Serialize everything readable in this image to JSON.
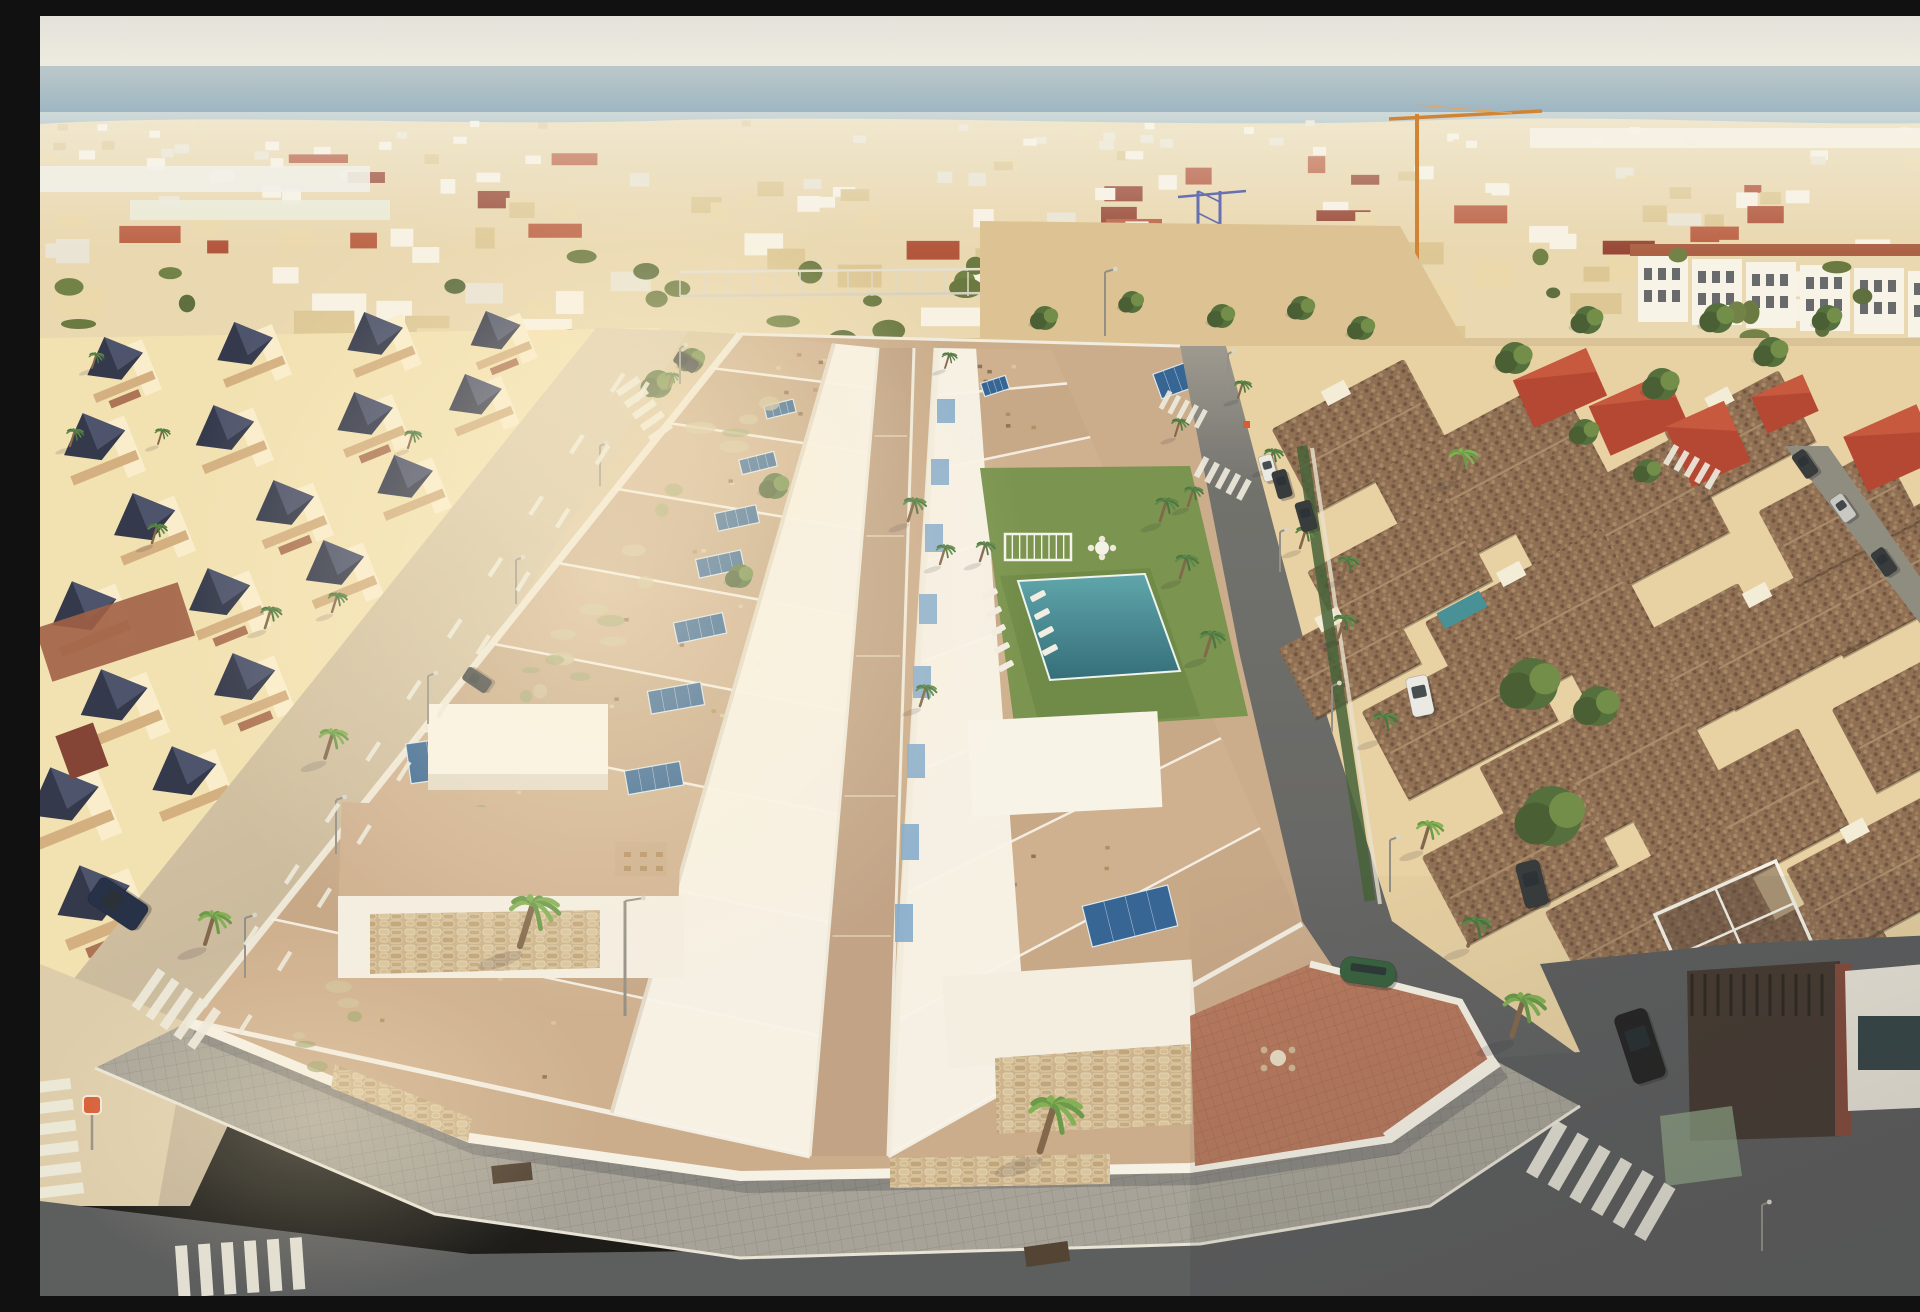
{
  "meta": {
    "label": "aerial-render-coastal-residential-development",
    "description": "computer-generated aerial view of a new white villa development with solar panels and communal pool beside older terracotta-roof urbanizations near the sea",
    "width": 1920,
    "height": 1280
  },
  "palette": {
    "sky_top": "#e3e2dd",
    "sky_horizon": "#efece3",
    "sea_far": "#b9c6cb",
    "sea_mid": "#6f9dbd",
    "sea_near": "#3f7ea9",
    "far_town_base": "#e8d7b0",
    "far_bld_white": "#f7f3e7",
    "far_bld_cream": "#ead8ab",
    "far_bld_sand": "#dcc694",
    "far_roof_red": "#ae4e36",
    "far_tree": "#64743c",
    "sand": "#d9c096",
    "dirt": "#dcc192",
    "left_wall": "#f2e1b2",
    "left_wall_lit": "#fbf0d2",
    "left_roof_dark": "#2a3047",
    "left_roof_light": "#4a5170",
    "left_parapet": "#d2ad7e",
    "left_roof_red": "#9c5a40",
    "ave_road": "#c8b698",
    "ave_road_lit": "#ddccab",
    "ave_walk": "#d8c4a0",
    "dev_white": "#f8f4ea",
    "dev_white_shade": "#e2dacb",
    "dev_terrace": "#c9aa8a",
    "dev_walkway": "#bfa084",
    "dev_stone": "#cbb28b",
    "panel_blue": "#2d5f93",
    "panel_frame": "#dce8f0",
    "glass_blue": "#7fa9cd",
    "straw": "#d8c094",
    "lawn": "#74904a",
    "lawn_dark": "#5e7a3a",
    "pool_deep": "#2b6877",
    "pool_light": "#57a3ab",
    "street_lit": "#98948a",
    "street_shade": "#5d5f60",
    "asphalt": "#55575a",
    "paver": "#a3a097",
    "paver_line": "#8d8a81",
    "curb": "#e8e4d8",
    "stripe": "#eceade",
    "right_wall": "#e7d0a2",
    "right_roof": "#8a6a50",
    "right_roof_dot": "#6b4e3a",
    "right_roof_dot2": "#a38363",
    "right_roof_red": "#b2402d",
    "terra": "#b3745a",
    "terra_line": "#9b6049",
    "palm_trunk": "#7d6247",
    "palm_dark": "#44703a",
    "palm_bright": "#649644",
    "tree_dark": "#4c6a36",
    "tree_light": "#6c8a44",
    "crane_orange": "#cf7f2e",
    "crane_blue": "#5f6ab0",
    "car_navy": "#1c2742",
    "car_white": "#e9e9e6",
    "car_black": "#1a1b1d",
    "car_dark": "#2f3336",
    "car_green": "#2f5c3a",
    "car_silver": "#c7c7c4",
    "hedge": "#3f5c33",
    "shadow": "rgba(45,42,60,0.28)",
    "glare": "rgba(255,242,210,0.32)",
    "sign_red": "#d4552e",
    "umbrella_yellow": "#e0b93c"
  },
  "scene": {
    "far_town": {
      "seed": 11,
      "building_count": 170,
      "red_roof_count": 22,
      "tree_count": 34,
      "band_top": 104,
      "band_bottom": 332
    },
    "cranes": {
      "orange": {
        "mast_x": 1377,
        "mast_top": 98,
        "mast_bottom": 322,
        "jib_x2": 1502,
        "jib_y": 95
      },
      "blue": {
        "x": 1158,
        "top": 175,
        "bottom": 490,
        "width": 22
      }
    },
    "development": {
      "left_row_units": 9,
      "right_row_units": 8,
      "solar_panels": [
        [
          740,
          393,
          30,
          13,
          -14
        ],
        [
          718,
          447,
          36,
          15,
          -14
        ],
        [
          697,
          502,
          42,
          18,
          -12
        ],
        [
          680,
          548,
          46,
          19,
          -12
        ],
        [
          660,
          612,
          50,
          21,
          -12
        ],
        [
          636,
          682,
          54,
          23,
          -10
        ],
        [
          614,
          762,
          56,
          24,
          -10
        ],
        [
          596,
          845,
          60,
          26,
          -8
        ],
        [
          410,
          742,
          84,
          40,
          -8
        ],
        [
          955,
          370,
          26,
          14,
          -18
        ],
        [
          1138,
          363,
          44,
          26,
          -20
        ],
        [
          1027,
          681,
          62,
          30,
          -16
        ],
        [
          1090,
          900,
          88,
          42,
          -14
        ]
      ],
      "glass_panels": [
        [
          906,
          395
        ],
        [
          900,
          455
        ],
        [
          894,
          520
        ],
        [
          888,
          590
        ],
        [
          882,
          662
        ],
        [
          876,
          740
        ],
        [
          870,
          820
        ],
        [
          864,
          900
        ]
      ],
      "loungers": [
        [
          950,
          578
        ],
        [
          954,
          596
        ],
        [
          958,
          614
        ],
        [
          962,
          632
        ],
        [
          966,
          650
        ],
        [
          998,
          580
        ],
        [
          1002,
          598
        ],
        [
          1006,
          616
        ],
        [
          1010,
          634
        ]
      ],
      "garden_bench": [
        965,
        518,
        66,
        26
      ],
      "table_set": [
        1062,
        532
      ],
      "straw_pergola": [
        995,
        468,
        112,
        34
      ]
    },
    "vegetation": {
      "palms": [
        [
          30,
          430,
          0.9,
          0
        ],
        [
          112,
          527,
          1.0,
          0
        ],
        [
          225,
          612,
          1.1,
          0
        ],
        [
          285,
          742,
          1.5,
          1
        ],
        [
          165,
          928,
          1.7,
          1
        ],
        [
          480,
          930,
          2.6,
          1
        ],
        [
          1000,
          1135,
          2.8,
          1
        ],
        [
          1472,
          1020,
          2.2,
          1
        ],
        [
          868,
          505,
          1.2,
          0
        ],
        [
          900,
          548,
          1.0,
          0
        ],
        [
          940,
          545,
          1.0,
          0
        ],
        [
          1120,
          505,
          1.2,
          0
        ],
        [
          1140,
          562,
          1.2,
          0
        ],
        [
          880,
          690,
          1.1,
          0
        ],
        [
          1165,
          640,
          1.3,
          0
        ],
        [
          1198,
          382,
          0.9,
          0
        ],
        [
          1228,
          452,
          1.0,
          0
        ],
        [
          1260,
          532,
          1.1,
          0
        ],
        [
          1298,
          622,
          1.2,
          0
        ],
        [
          1338,
          722,
          1.3,
          0
        ],
        [
          1382,
          832,
          1.4,
          1
        ],
        [
          1428,
          930,
          1.5,
          0
        ],
        [
          1415,
          462,
          1.5,
          1
        ],
        [
          1302,
          562,
          1.1,
          0
        ],
        [
          368,
          432,
          0.9,
          0
        ],
        [
          292,
          596,
          1.0,
          0
        ],
        [
          118,
          428,
          0.8,
          0
        ],
        [
          52,
          352,
          0.8,
          0
        ],
        [
          905,
          352,
          0.8,
          0
        ],
        [
          628,
          372,
          0.8,
          0
        ],
        [
          1135,
          420,
          0.9,
          0
        ],
        [
          1148,
          490,
          1.0,
          0
        ]
      ],
      "trees": [
        [
          618,
          368,
          14
        ],
        [
          652,
          344,
          12
        ],
        [
          1475,
          342,
          16
        ],
        [
          1548,
          304,
          14
        ],
        [
          1622,
          368,
          16
        ],
        [
          1678,
          302,
          15
        ],
        [
          1732,
          336,
          15
        ],
        [
          1788,
          302,
          13
        ],
        [
          1005,
          302,
          12
        ],
        [
          1092,
          286,
          11
        ],
        [
          1182,
          300,
          12
        ],
        [
          1262,
          292,
          12
        ],
        [
          1322,
          312,
          12
        ],
        [
          1545,
          416,
          13
        ],
        [
          1608,
          455,
          12
        ],
        [
          1492,
          668,
          26
        ],
        [
          1512,
          800,
          30
        ],
        [
          1558,
          690,
          20
        ],
        [
          735,
          470,
          13
        ],
        [
          700,
          560,
          12
        ]
      ]
    },
    "vehicles": {
      "cars": [
        [
          78,
          888,
          30,
          58,
          -56,
          "car_navy"
        ],
        [
          437,
          664,
          15,
          28,
          -56,
          "car_dark"
        ],
        [
          646,
          346,
          13,
          24,
          -58,
          "car_dark"
        ],
        [
          1380,
          680,
          22,
          40,
          -12,
          "car_white"
        ],
        [
          1492,
          868,
          24,
          46,
          -14,
          "car_dark"
        ],
        [
          1600,
          1030,
          34,
          72,
          -18,
          "car_black"
        ],
        [
          1328,
          956,
          56,
          26,
          8,
          "car_green"
        ],
        [
          1228,
          452,
          14,
          26,
          -16,
          "car_white"
        ],
        [
          1242,
          468,
          15,
          28,
          -16,
          "car_dark"
        ],
        [
          1266,
          500,
          16,
          30,
          -16,
          "car_dark"
        ],
        [
          1765,
          448,
          15,
          28,
          -35,
          "car_dark"
        ],
        [
          1803,
          492,
          15,
          28,
          -35,
          "car_silver"
        ],
        [
          1844,
          546,
          15,
          28,
          -35,
          "car_dark"
        ]
      ]
    },
    "road_markings": {
      "crosswalks": [
        [
          30,
          1062,
          6,
          11,
          50,
          10,
          83
        ],
        [
          118,
          952,
          5,
          9,
          46,
          8,
          35
        ],
        [
          135,
          1230,
          6,
          12,
          52,
          11,
          -4
        ],
        [
          1516,
          1104,
          6,
          13,
          60,
          12,
          30
        ],
        [
          1634,
          428,
          5,
          6,
          22,
          6,
          30
        ],
        [
          597,
          360,
          5,
          7,
          26,
          7,
          55
        ],
        [
          1128,
          374,
          5,
          5,
          20,
          5,
          28
        ],
        [
          1164,
          440,
          5,
          6,
          22,
          6,
          28
        ]
      ],
      "dash_lines": [
        [
          598,
          336,
          150,
          1012,
          11
        ],
        [
          622,
          344,
          185,
          1040,
          11
        ]
      ]
    },
    "street_lights": [
      [
        640,
        368,
        36
      ],
      [
        560,
        470,
        40
      ],
      [
        476,
        588,
        44
      ],
      [
        388,
        708,
        48
      ],
      [
        296,
        838,
        54
      ],
      [
        205,
        962,
        60
      ],
      [
        1188,
        372,
        34
      ],
      [
        1240,
        556,
        40
      ],
      [
        1292,
        716,
        46
      ],
      [
        1350,
        876,
        52
      ],
      [
        585,
        1000,
        115
      ],
      [
        1722,
        1235,
        46
      ],
      [
        1065,
        320,
        64
      ]
    ],
    "signs": {
      "red_sign": [
        52,
        1088
      ],
      "small_red_sign": [
        1206,
        408
      ],
      "billboard": [
        1068,
        212,
        72,
        22
      ]
    }
  }
}
